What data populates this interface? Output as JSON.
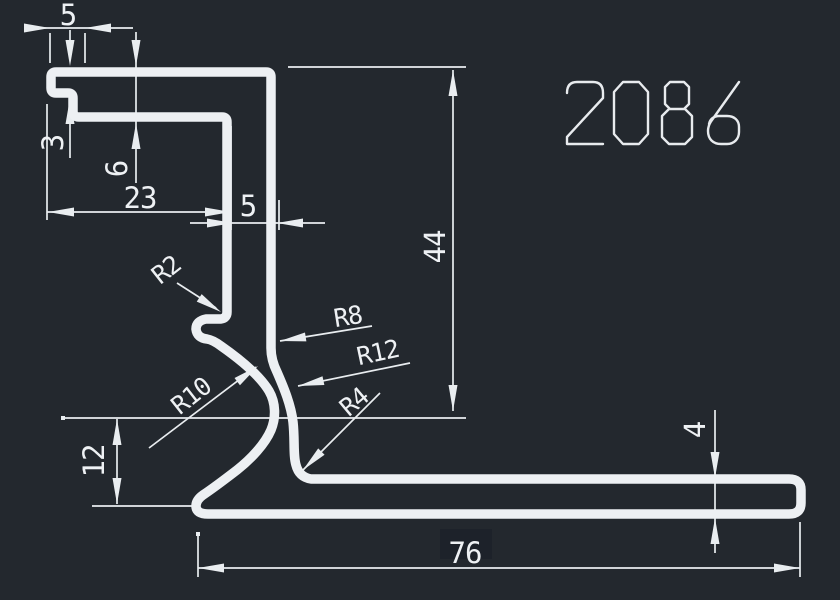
{
  "title": {
    "part_number": "2086"
  },
  "colors": {
    "background": "#23282e",
    "line": "#edf0f3",
    "dim_line": "#e9edf0",
    "text": "#eef1f4",
    "text_mask": "#1d222a"
  },
  "dimensions": {
    "top_hook_width": "5",
    "hook_depth": "3",
    "arm_step": "6",
    "top_arm_length": "23",
    "stem_width": "5",
    "overall_height": "44",
    "bowl_height": "12",
    "flange_thickness": "4",
    "flange_length": "76"
  },
  "radii": {
    "notch": "R2",
    "neck_outer": "R8",
    "neck_mid": "R12",
    "bowl": "R10",
    "flange_fillet": "R4"
  }
}
